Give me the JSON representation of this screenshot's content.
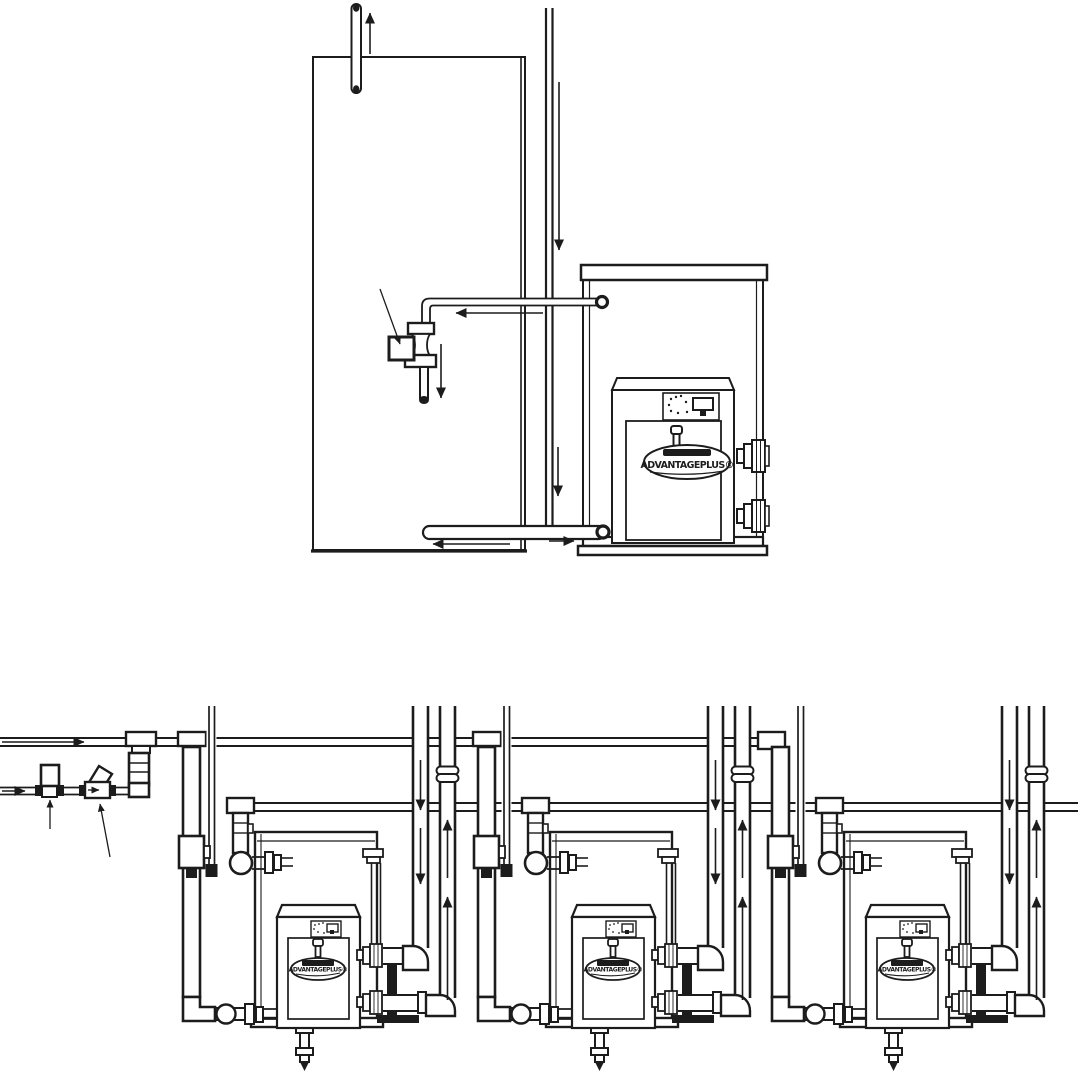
{
  "page": {
    "background_color": "#ffffff",
    "line_color": "#1c1c1c",
    "figure": "gas-water-heater-piping-diagrams"
  },
  "brand": {
    "logo_text": "ADVANTAGEPLUS®"
  },
  "top_diagram": {
    "name": "single-heater-with-storage-tank",
    "components": [
      "storage-tank",
      "relief-discharge-pipe",
      "vent-pipe",
      "three-way-valve-with-actuator",
      "valve-callout-arrow",
      "heater-cabinet",
      "control-panel",
      "door-knob",
      "brand-logo-plate",
      "side-pipe-connections",
      "tank-outlet-pipe",
      "tank-return-pipe"
    ],
    "flow_arrows": [
      "up",
      "down",
      "left",
      "down",
      "down",
      "left",
      "right"
    ]
  },
  "bottom_diagram": {
    "name": "three-heater-manifold-installation",
    "unit_count": 3,
    "headers": [
      "cold-water-supply-main",
      "hot-water-return-main",
      "make-up-water-line"
    ],
    "inlet_components": [
      "pressure-reducing-valve",
      "y-strainer",
      "feed-valve-callout-arrow",
      "strainer-callout-arrow"
    ],
    "unit_components": [
      "supply-drop-pipe",
      "shutoff-valve",
      "gas-line",
      "circulator-pump",
      "isolation-valve",
      "rear-enclosure",
      "heater-cabinet",
      "control-panel",
      "door-knob",
      "brand-logo-plate",
      "union-fittings",
      "ball-valve",
      "drain-valve",
      "combustion-air-pipe",
      "flue-exhaust-pipe",
      "vent-coupling",
      "pipe-support-stand",
      "side-pipe-connections"
    ],
    "flow_arrows": [
      "right",
      "right",
      "down",
      "down",
      "up",
      "up",
      "down"
    ]
  }
}
